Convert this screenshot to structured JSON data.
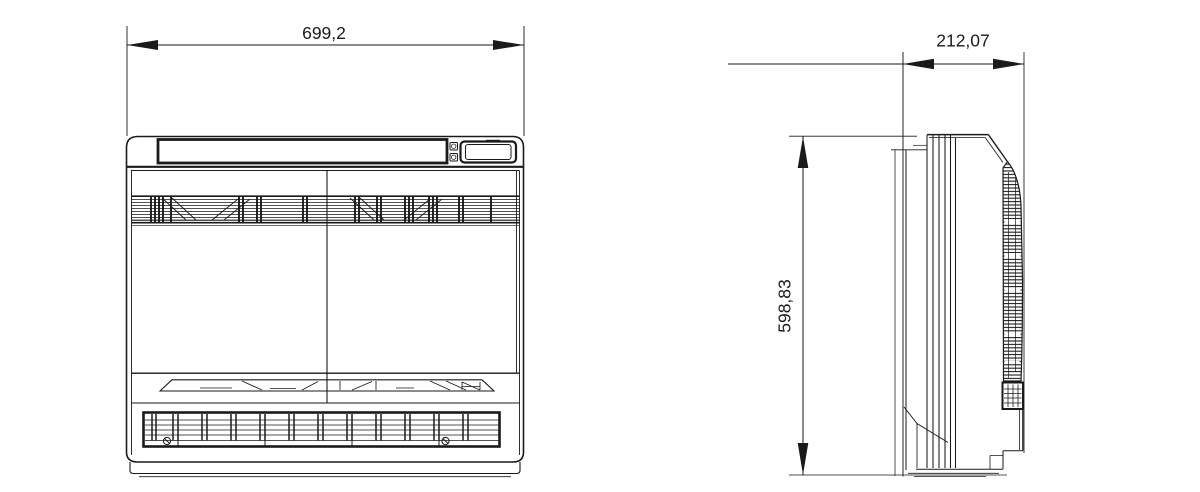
{
  "drawing": {
    "dimensions": {
      "width": "699,2",
      "depth": "212,07",
      "height": "598,83"
    }
  },
  "colors": {
    "line": "#1a1a1a",
    "background": "#ffffff"
  }
}
